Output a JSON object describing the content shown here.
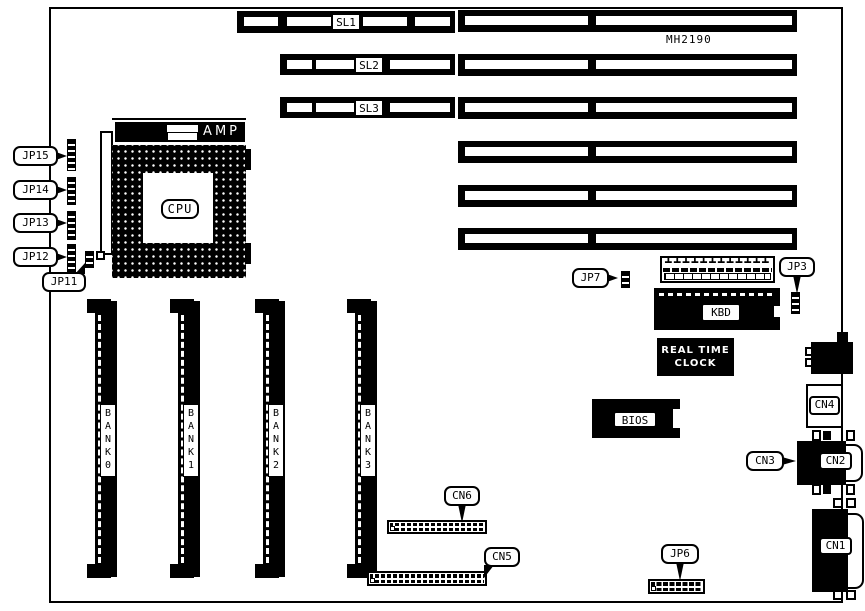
{
  "board": {
    "model": "MH2190"
  },
  "cpu": {
    "socket": "CPU",
    "regulator": "AMP"
  },
  "slots": [
    {
      "label": "SL1"
    },
    {
      "label": "SL2"
    },
    {
      "label": "SL3"
    }
  ],
  "jumpers": {
    "jp15": "JP15",
    "jp14": "JP14",
    "jp13": "JP13",
    "jp12": "JP12",
    "jp11": "JP11",
    "jp7": "JP7",
    "jp3": "JP3",
    "jp6": "JP6"
  },
  "memory_banks": [
    {
      "label": "B\nA\nN\nK\n0"
    },
    {
      "label": "B\nA\nN\nK\n1"
    },
    {
      "label": "B\nA\nN\nK\n2"
    },
    {
      "label": "B\nA\nN\nK\n3"
    }
  ],
  "chips": {
    "keyboard_controller": "KBD",
    "real_time_clock": "REAL TIME\nCLOCK",
    "bios": "BIOS"
  },
  "connectors": {
    "cn1": "CN1",
    "cn2": "CN2",
    "cn3": "CN3",
    "cn4": "CN4",
    "cn5": "CN5",
    "cn6": "CN6"
  },
  "icons": {
    "power_pin_row": "┻┻┻┻┻┻┻┻┻┻┻┻"
  }
}
